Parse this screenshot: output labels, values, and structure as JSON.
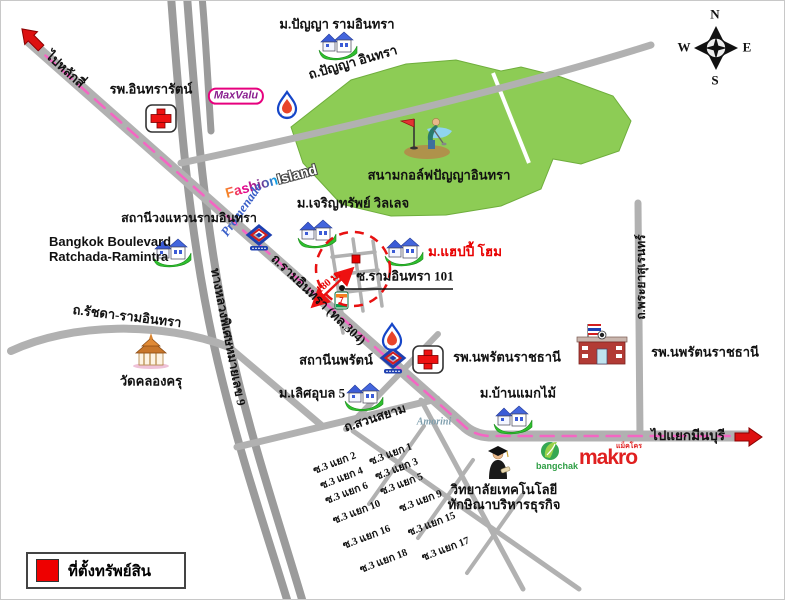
{
  "map": {
    "directions": {
      "to_laksi": "ไปหลักสี่",
      "to_minburi": "ไปแยกมีนบุรี"
    },
    "roads": {
      "panya": "ถ.ปัญญา อินทรา",
      "ramintra": "ถ.รามอินทรา (ทล.304)",
      "ratchada": "ถ.รัชดา-รามอินทรา",
      "motorway9": "ทางหลวงพิเศษหมายเลข 9",
      "phraya_suren": "ถ.พระยาสุเรนทร์",
      "suan_siam": "ถ.สวนสยาม",
      "soi101": "ซ.รามอินทรา 101"
    },
    "places": {
      "indra_hospital": "รพ.อินทรารัตน์",
      "panya_village": "ม.ปัญญา รามอินทรา",
      "golf": "สนามกอล์ฟปัญญาอินทรา",
      "wongwaen_station": "สถานีวงแหวนรามอินทรา",
      "bkk_blvd": "Bangkok Boulevard\nRatchada-Ramintra",
      "charoensap": "ม.เจริญทรัพย์ วิลเลจ",
      "happy_home": "ม.แฮปปี้ โฮม",
      "wat_klongkru": "วัดคลองครุ",
      "nopparat_station": "สถานีนพรัตน์",
      "nopparat_hospital": "รพ.นพรัตนราชธานี",
      "nopparat_hospital_building": "รพ.นพรัตนราชธานี",
      "lertubon": "ม.เลิศอุบล 5",
      "banmakmai": "ม.บ้านแมกไม้",
      "college": "วิทยาลัยเทคโนโลยี\nทักษิณาบริหารธุรกิจ"
    },
    "brands": {
      "maxvalu": "MaxValu",
      "fashion": "Fashion",
      "island": "Island",
      "promenade": "Promenade",
      "amorini": "Amorini",
      "bangchak": "bangchak",
      "makro": "makro",
      "makro_thai": "แม็คโคร"
    },
    "distance_to_site": "180 ม.",
    "sois": [
      "ซ.3 แยก 2",
      "ซ.3 แยก 1",
      "ซ.3 แยก 4",
      "ซ.3 แยก 3",
      "ซ.3 แยก 6",
      "ซ.3 แยก 5",
      "ซ.3 แยก 10",
      "ซ.3 แยก 9",
      "ซ.3 แยก 16",
      "ซ.3 แยก 15",
      "ซ.3 แยก 18",
      "ซ.3 แยก 17"
    ],
    "legend": {
      "label": "ที่ตั้งทรัพย์สิน"
    },
    "compass": {
      "n": "N",
      "s": "S",
      "e": "E",
      "w": "W"
    },
    "colors": {
      "route_dash": "#f466c3",
      "golf_green": "#8dcc55",
      "road_gray": "#b1b1b1",
      "marker_red": "#e80000"
    }
  }
}
